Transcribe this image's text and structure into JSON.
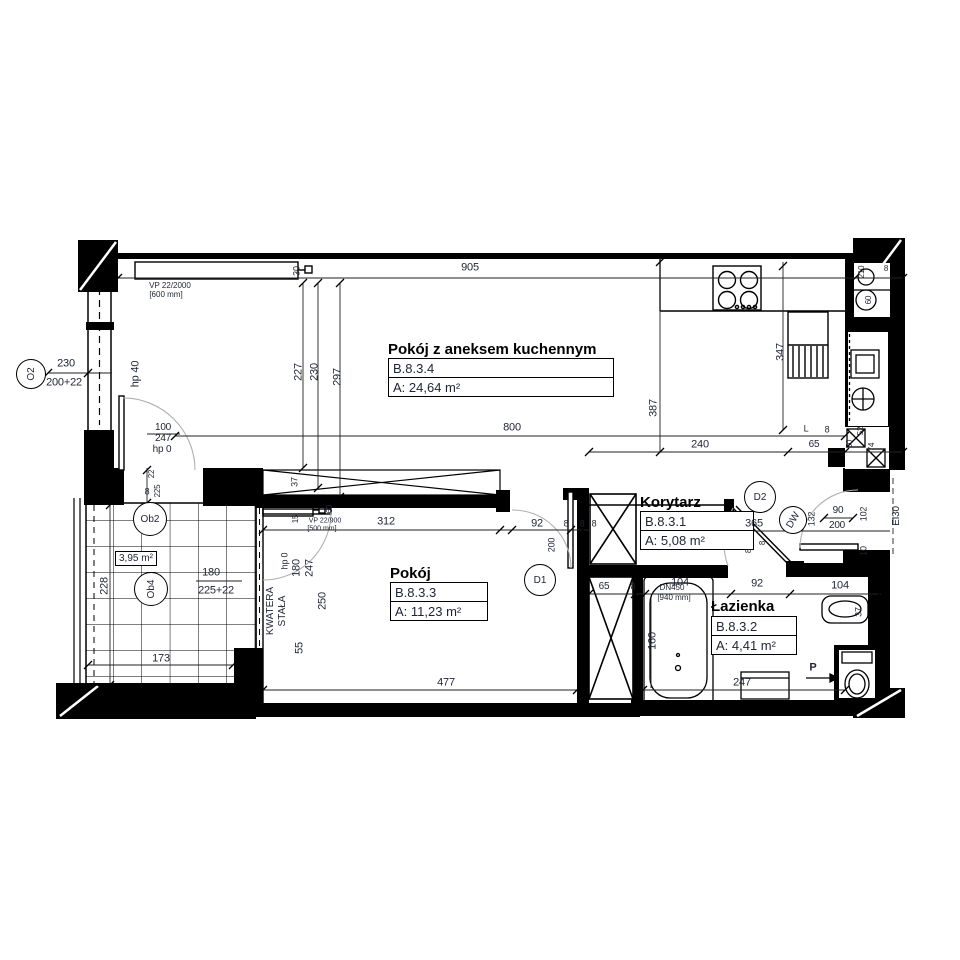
{
  "rooms": [
    {
      "name": "Pokój z aneksem kuchennym",
      "id": "B.8.3.4",
      "area": "A: 24,64 m²"
    },
    {
      "name": "Pokój",
      "id": "B.8.3.3",
      "area": "A: 11,23 m²"
    },
    {
      "name": "Korytarz",
      "id": "B.8.3.1",
      "area": "A: 5,08 m²"
    },
    {
      "name": "Łazienka",
      "id": "B.8.3.2",
      "area": "A: 4,41 m²"
    }
  ],
  "balcony": {
    "area": "3,95 m²"
  },
  "colors": {
    "line": "#000000",
    "text": "#1d2433",
    "arc": "#b0b0b0"
  },
  "markers": [
    {
      "t": "O2",
      "x": 31,
      "y": 374,
      "d": 30,
      "r": -90
    },
    {
      "t": "Ob2",
      "x": 150,
      "y": 519,
      "d": 34,
      "r": 0
    },
    {
      "t": "Ob4",
      "x": 151,
      "y": 589,
      "d": 34,
      "r": -90
    },
    {
      "t": "D1",
      "x": 540,
      "y": 580,
      "d": 32,
      "r": 0
    },
    {
      "t": "D2",
      "x": 760,
      "y": 497,
      "d": 32,
      "r": 0
    },
    {
      "t": "DW",
      "x": 793,
      "y": 520,
      "d": 28,
      "r": -60
    }
  ],
  "dimensions": [
    {
      "t": "905",
      "x": 470,
      "y": 268
    },
    {
      "t": "30",
      "x": 297,
      "y": 271,
      "r": -90,
      "s": 9
    },
    {
      "t": "227",
      "x": 299,
      "y": 372,
      "r": -90
    },
    {
      "t": "230",
      "x": 315,
      "y": 372,
      "r": -90
    },
    {
      "t": "297",
      "x": 338,
      "y": 377,
      "r": -90
    },
    {
      "t": "387",
      "x": 654,
      "y": 408,
      "r": -90
    },
    {
      "t": "347",
      "x": 781,
      "y": 352,
      "r": -90
    },
    {
      "t": "800",
      "x": 512,
      "y": 428
    },
    {
      "t": "240",
      "x": 700,
      "y": 445
    },
    {
      "t": "L",
      "x": 806,
      "y": 429,
      "s": 9
    },
    {
      "t": "65",
      "x": 814,
      "y": 445,
      "s": 10
    },
    {
      "t": "8",
      "x": 827,
      "y": 430,
      "s": 9
    },
    {
      "t": "230",
      "x": 66,
      "y": 364
    },
    {
      "t": "200+22",
      "x": 64,
      "y": 383
    },
    {
      "t": "hp 40",
      "x": 136,
      "y": 374,
      "r": -90
    },
    {
      "t": "100",
      "x": 163,
      "y": 428,
      "s": 10
    },
    {
      "t": "247",
      "x": 163,
      "y": 439,
      "s": 10
    },
    {
      "t": "hp 0",
      "x": 162,
      "y": 450,
      "s": 10
    },
    {
      "t": "22",
      "x": 152,
      "y": 474,
      "r": -90,
      "s": 8
    },
    {
      "t": "8",
      "x": 147,
      "y": 492,
      "s": 9
    },
    {
      "t": "225",
      "x": 158,
      "y": 491,
      "r": -90,
      "s": 8
    },
    {
      "t": "228",
      "x": 105,
      "y": 586,
      "r": -90
    },
    {
      "t": "180",
      "x": 211,
      "y": 573
    },
    {
      "t": "225+22",
      "x": 216,
      "y": 591
    },
    {
      "t": "173",
      "x": 161,
      "y": 659
    },
    {
      "t": "37",
      "x": 295,
      "y": 482,
      "r": -90,
      "s": 9
    },
    {
      "t": "15",
      "x": 296,
      "y": 519,
      "r": -90,
      "s": 8
    },
    {
      "t": "60",
      "x": 330,
      "y": 509,
      "r": -90,
      "s": 8
    },
    {
      "t": "312",
      "x": 386,
      "y": 522
    },
    {
      "t": "92",
      "x": 537,
      "y": 524
    },
    {
      "t": "8",
      "x": 566,
      "y": 524,
      "s": 9
    },
    {
      "t": "8",
      "x": 582,
      "y": 524,
      "s": 9
    },
    {
      "t": "8",
      "x": 594,
      "y": 524,
      "s": 9
    },
    {
      "t": "200",
      "x": 552,
      "y": 545,
      "r": -90,
      "s": 9
    },
    {
      "t": "hp 0",
      "x": 285,
      "y": 561,
      "r": -90,
      "s": 9
    },
    {
      "t": "180",
      "x": 297,
      "y": 568,
      "r": -90
    },
    {
      "t": "247",
      "x": 310,
      "y": 568,
      "r": -90
    },
    {
      "t": "250",
      "x": 323,
      "y": 601,
      "r": -90
    },
    {
      "t": "55",
      "x": 300,
      "y": 648,
      "r": -90
    },
    {
      "t": "477",
      "x": 446,
      "y": 683
    },
    {
      "t": "365",
      "x": 754,
      "y": 524
    },
    {
      "t": "132",
      "x": 812,
      "y": 519,
      "r": -90,
      "s": 9
    },
    {
      "t": "90",
      "x": 838,
      "y": 511,
      "s": 10
    },
    {
      "t": "200",
      "x": 837,
      "y": 526,
      "s": 10
    },
    {
      "t": "102",
      "x": 864,
      "y": 514,
      "r": -90,
      "s": 9
    },
    {
      "t": "10",
      "x": 864,
      "y": 551,
      "r": -90,
      "s": 9
    },
    {
      "t": "EI30",
      "x": 897,
      "y": 516,
      "r": -90,
      "s": 10
    },
    {
      "t": "65",
      "x": 604,
      "y": 587,
      "s": 10
    },
    {
      "t": "8",
      "x": 633,
      "y": 587,
      "s": 9
    },
    {
      "t": "104",
      "x": 680,
      "y": 583
    },
    {
      "t": "92",
      "x": 757,
      "y": 584
    },
    {
      "t": "104",
      "x": 840,
      "y": 586
    },
    {
      "t": "8",
      "x": 749,
      "y": 551,
      "r": -90,
      "s": 8
    },
    {
      "t": "8",
      "x": 763,
      "y": 543,
      "r": -90,
      "s": 8
    },
    {
      "t": "160",
      "x": 653,
      "y": 641,
      "r": -90
    },
    {
      "t": "247",
      "x": 742,
      "y": 683
    },
    {
      "t": "37",
      "x": 859,
      "y": 612,
      "r": -90,
      "s": 9
    },
    {
      "t": "210",
      "x": 862,
      "y": 272,
      "r": -90,
      "s": 8
    },
    {
      "t": "60",
      "x": 869,
      "y": 300,
      "r": -90,
      "s": 8
    },
    {
      "t": "8",
      "x": 886,
      "y": 269,
      "s": 8
    },
    {
      "t": "50",
      "x": 850,
      "y": 444,
      "r": -90,
      "s": 8
    },
    {
      "t": "52",
      "x": 861,
      "y": 431,
      "r": -90,
      "s": 8
    },
    {
      "t": "74",
      "x": 872,
      "y": 447,
      "r": -90,
      "s": 8
    }
  ],
  "annotations": [
    {
      "t": "VP 22/2000",
      "x": 170,
      "y": 286,
      "s": 8
    },
    {
      "t": "[600 mm]",
      "x": 166,
      "y": 295,
      "s": 8
    },
    {
      "t": "VP 22/900",
      "x": 325,
      "y": 521,
      "s": 7
    },
    {
      "t": "[500 mm]",
      "x": 322,
      "y": 529,
      "s": 7
    },
    {
      "t": "DN450",
      "x": 672,
      "y": 588,
      "s": 8
    },
    {
      "t": "[940 mm]",
      "x": 674,
      "y": 598,
      "s": 8
    },
    {
      "t": "KWATERA",
      "x": 271,
      "y": 611,
      "r": -90,
      "s": 10
    },
    {
      "t": "STAŁA",
      "x": 283,
      "y": 611,
      "r": -90,
      "s": 10
    },
    {
      "t": "P",
      "x": 813,
      "y": 668,
      "s": 11,
      "w": "bold"
    }
  ]
}
